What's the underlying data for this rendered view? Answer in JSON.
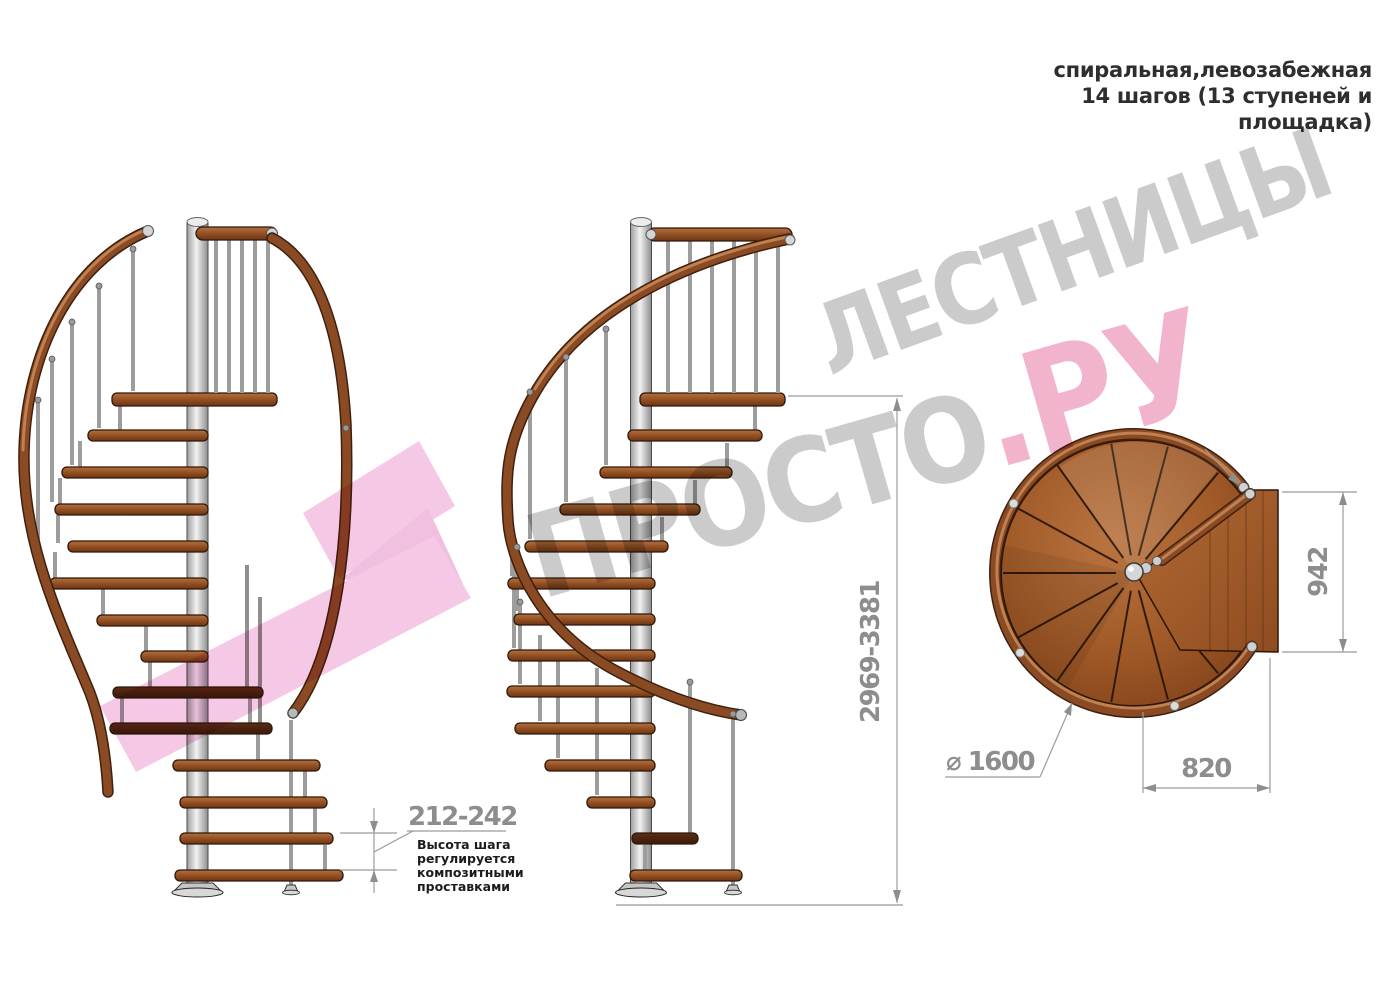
{
  "header": {
    "lines": [
      "спиральная,левозабежная",
      "14 шагов (13 ступеней и",
      "площадка)"
    ]
  },
  "dimensions": {
    "total_height": "2969-3381",
    "step_height": "212-242",
    "step_height_note_lines": [
      "Высота шага",
      "регулируется",
      "композитными",
      "проставками"
    ],
    "plan_diameter": "⌀ 1600",
    "plan_exit_width": "820",
    "plan_depth": "942"
  },
  "watermark": {
    "word_top": "ЛЕСТНИЦЫ",
    "word_bottom_gray": "ПРОСТО",
    "word_bottom_pink": ".РУ"
  },
  "colors": {
    "wood": "#8a4a24",
    "wood_dark": "#4a2412",
    "handrail": "#8a4a24",
    "metal": "#d5d5d5",
    "dimension_gray": "#8d8d8d",
    "note_text": "#1c1c1c",
    "watermark_gray": "#cbcbcb",
    "watermark_pink": "#f2b3cc",
    "logo_pink": "#f5c9e5"
  }
}
